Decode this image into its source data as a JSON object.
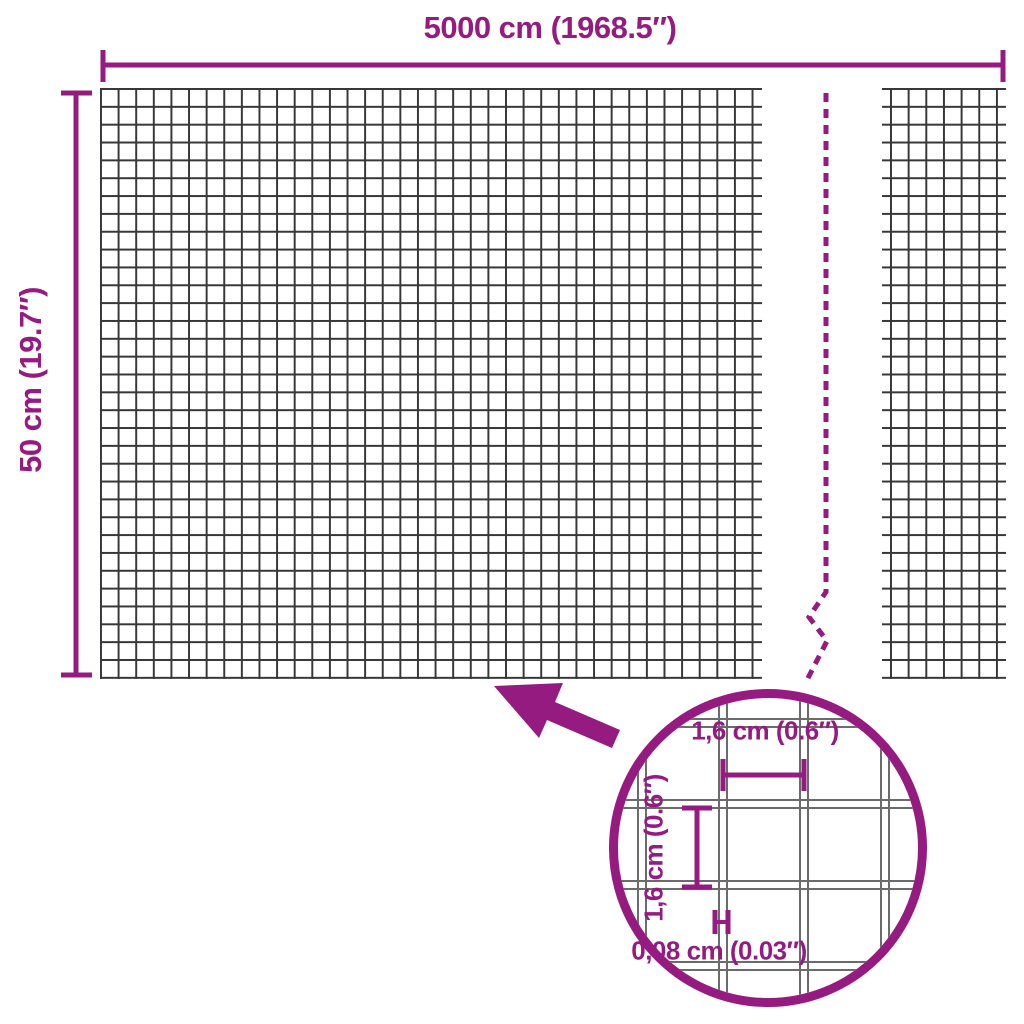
{
  "figure": {
    "type": "product-dimension-diagram",
    "product": "wire mesh / garden fence roll",
    "colors": {
      "accent": "#951b81",
      "grid": "#373737",
      "wire": "#6b6b6b"
    },
    "width_label": "5000 cm (1968.5″)",
    "height_label": "50 cm (19.7″)",
    "lens": {
      "cell_width_label": "1,6 cm (0.6″)",
      "cell_height_label": "1,6 cm (0.6″)",
      "wire_thickness_label": "0,08 cm (0.03″)"
    },
    "mesh": {
      "main_panel_cols": 37,
      "main_panel_rows": 33,
      "right_panel_cols": 6,
      "right_panel_rows": 33,
      "break_style": "dashed zigzag continuation line"
    }
  }
}
